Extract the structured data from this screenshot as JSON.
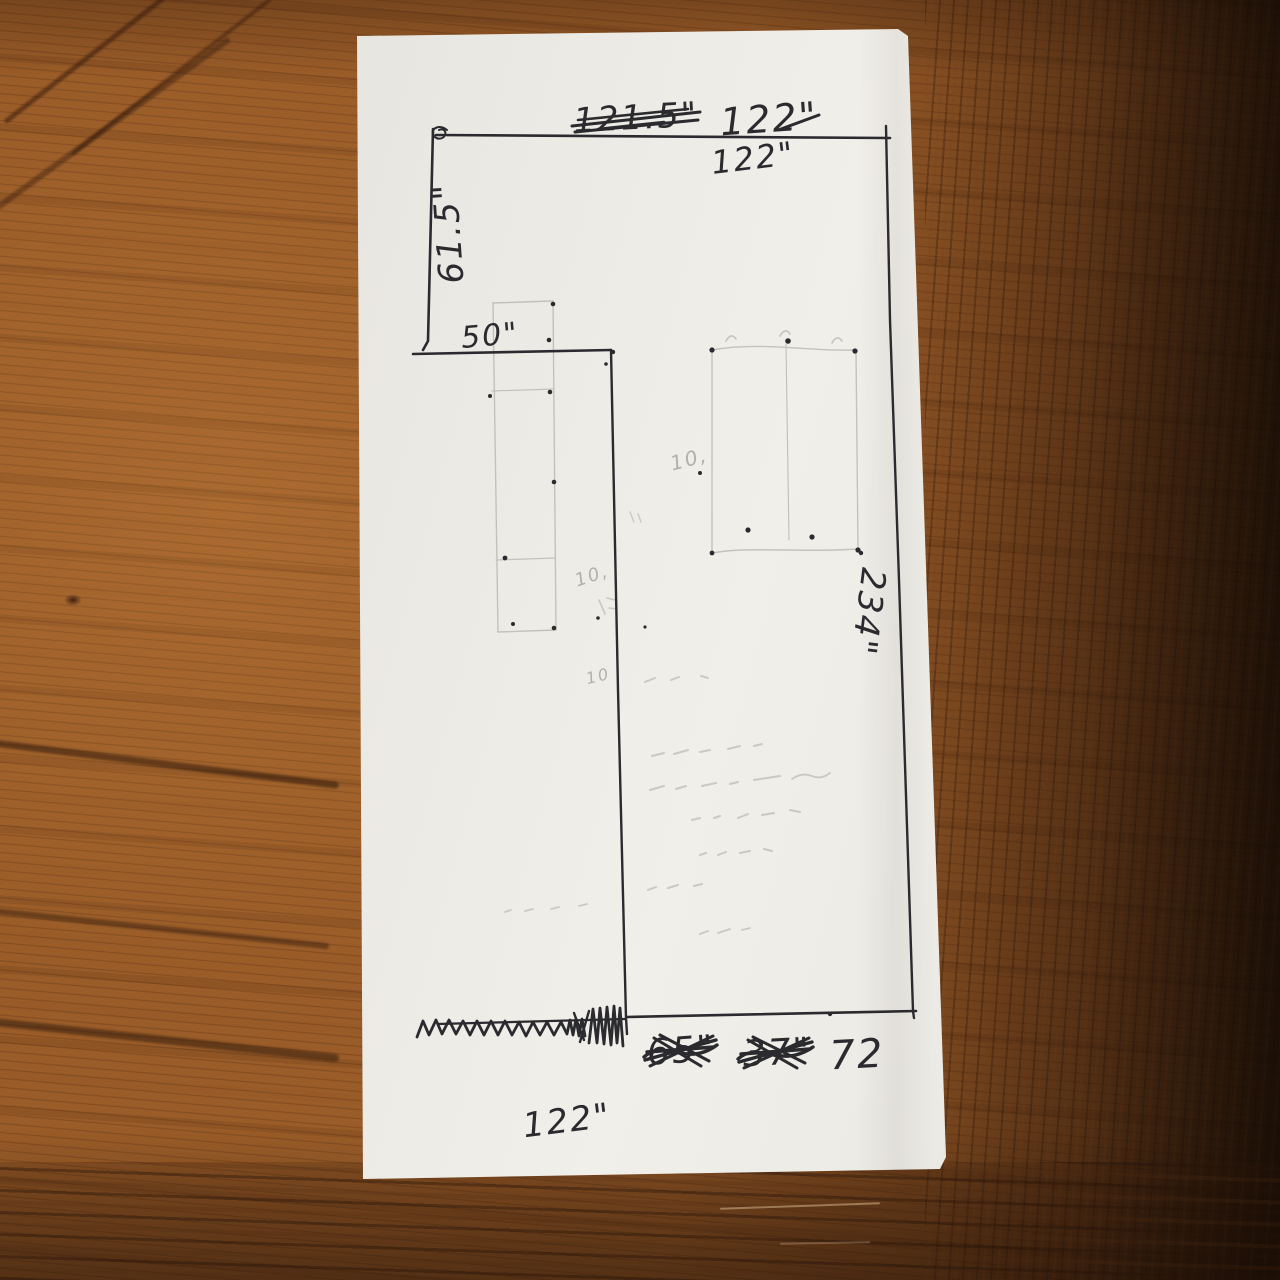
{
  "colors": {
    "ink": "#2b2b2f",
    "pencil": "#b2b0a9",
    "paper": "#edebe6",
    "wood_mid": "#9a5c28",
    "wood_dark": "#3a1d0c"
  },
  "sketch": {
    "labels": {
      "top_crossed_out": "121.5\"",
      "top_value": "122\"",
      "top_value_rewritten": "122\"",
      "left_height": "61.5\"",
      "notch_width": "50\"",
      "right_height": "234\"",
      "bottom_crossed_out_1": "65\"",
      "bottom_crossed_out_2": "37\"",
      "bottom_segment": "72",
      "bottom_width": "122\"",
      "faint_note_1": "10,",
      "faint_note_2": "10,",
      "faint_note_3": "10"
    }
  }
}
